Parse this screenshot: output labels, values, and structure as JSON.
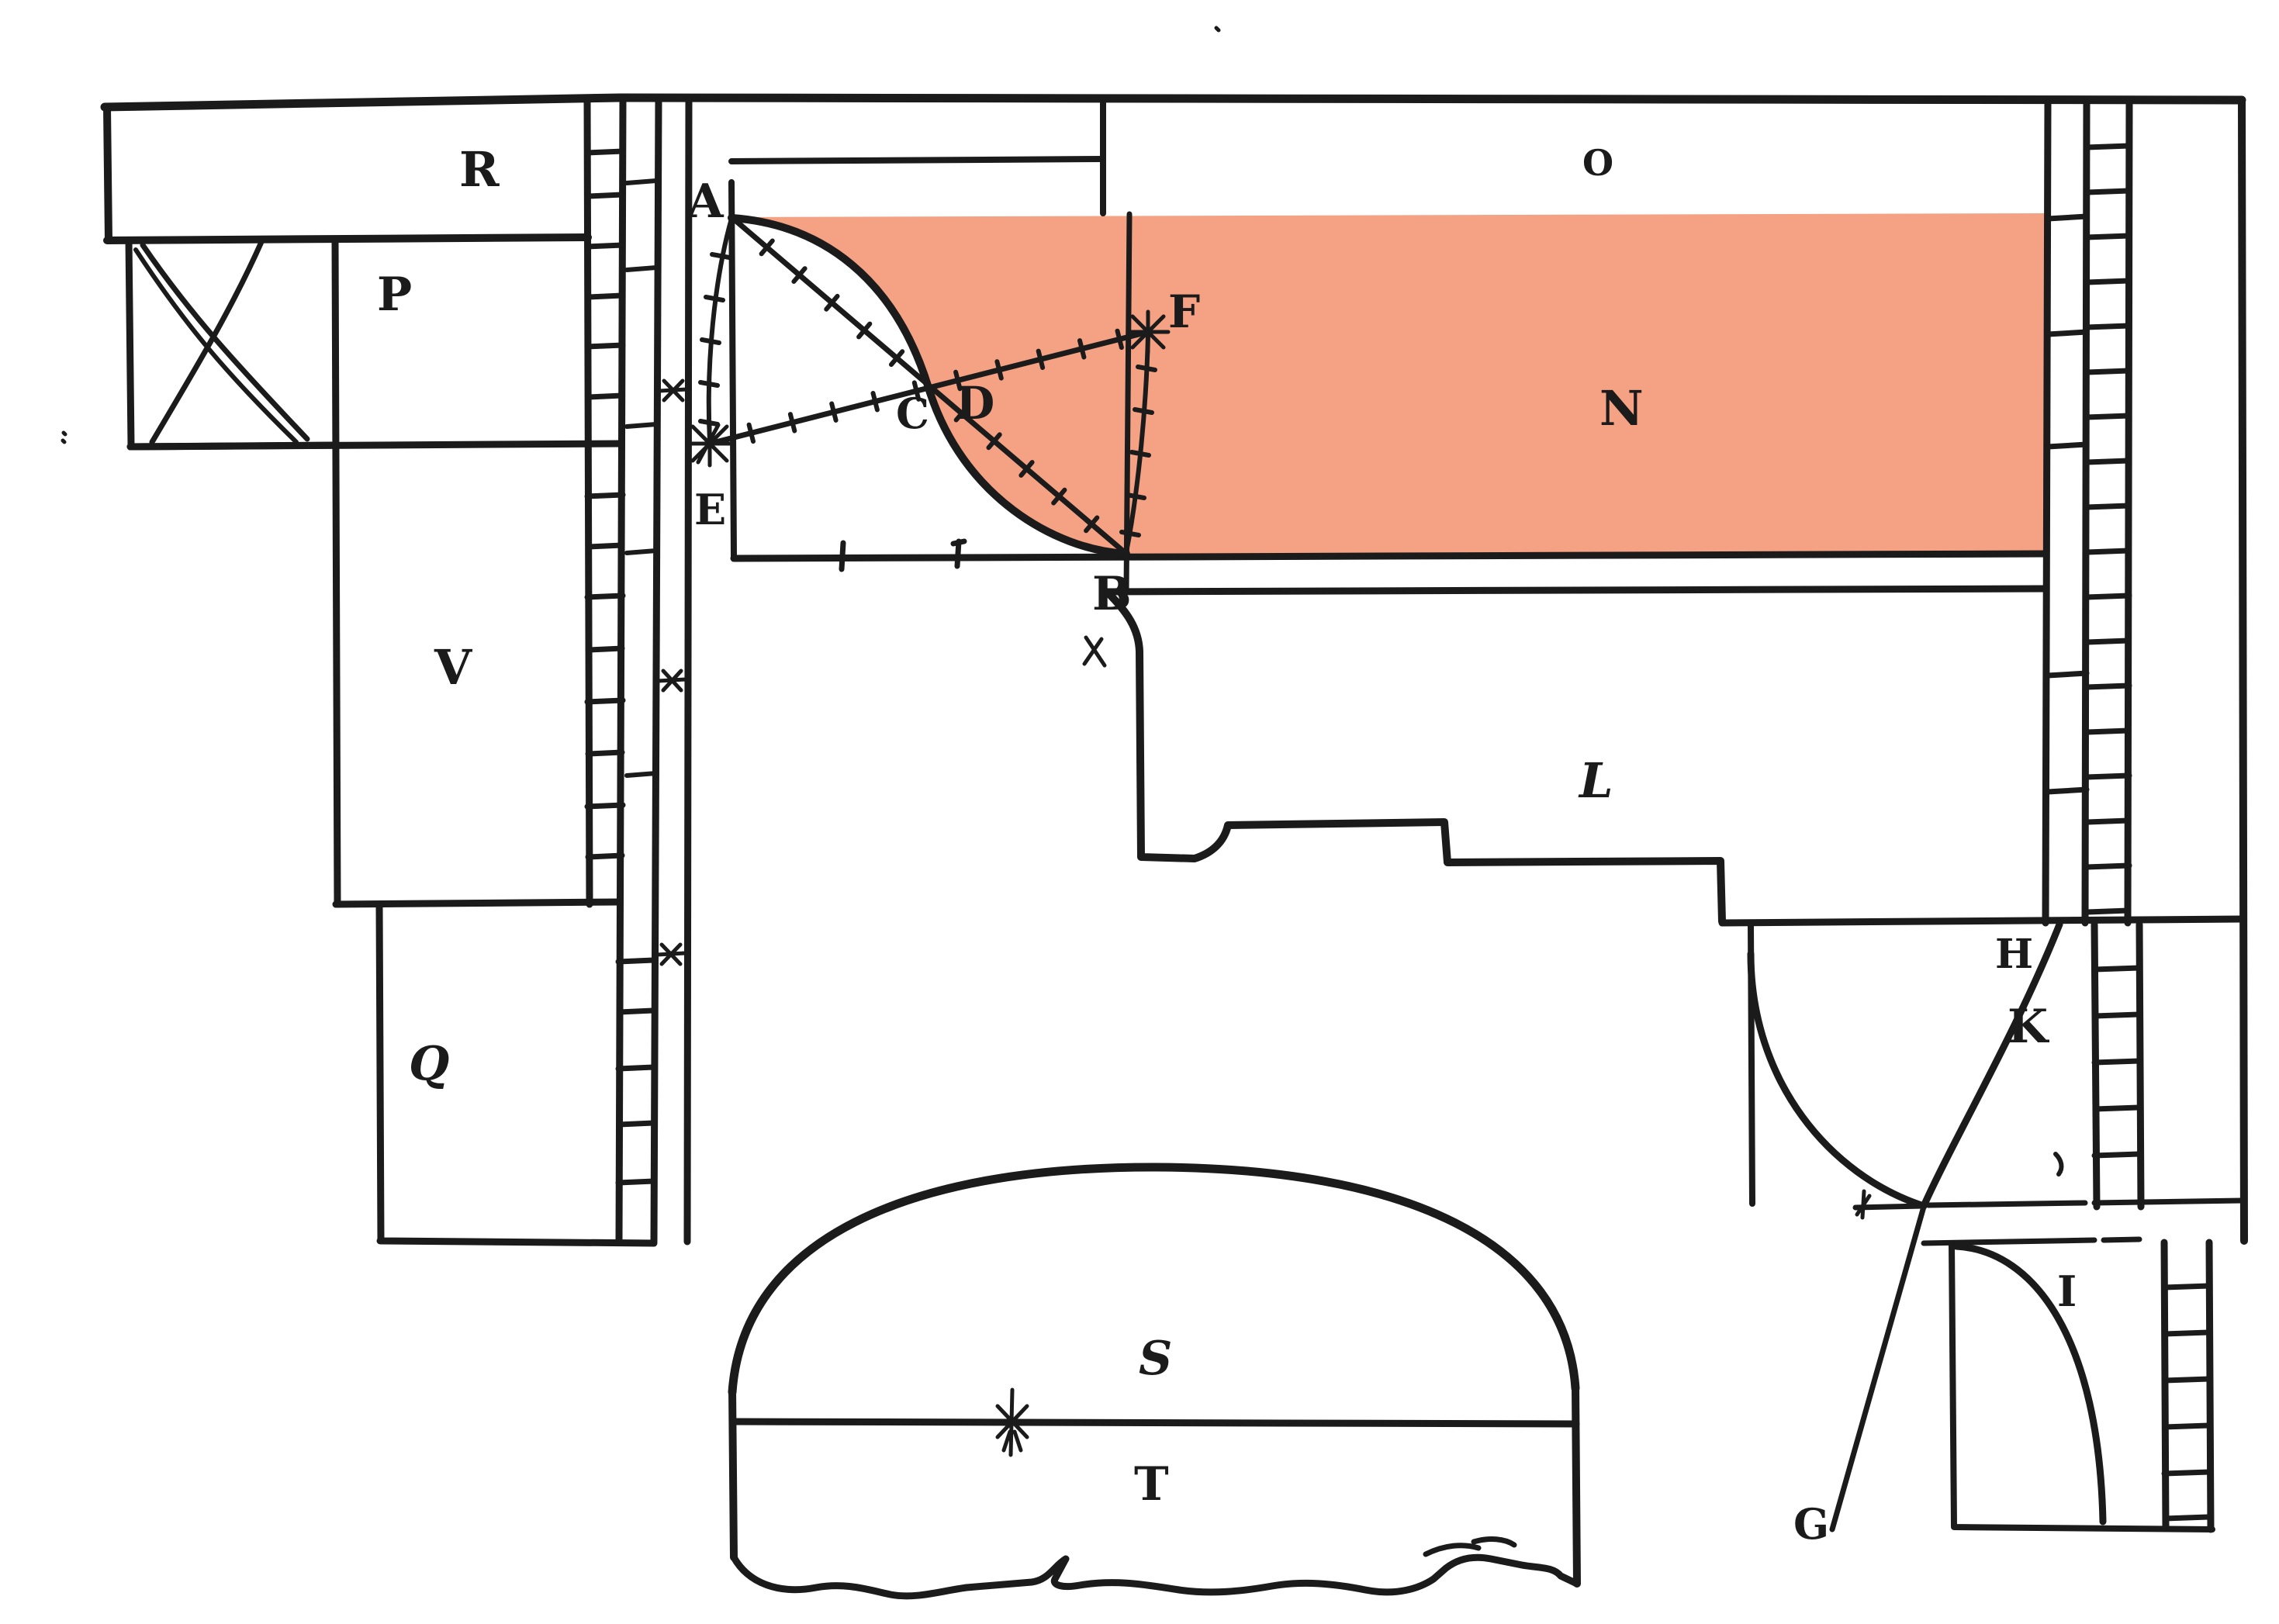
{
  "colors": {
    "ink": "#1b1b1b",
    "highlight": "#f5a183",
    "paper": "#ffffff"
  },
  "labels": {
    "A": "A",
    "B": "B",
    "C": "C",
    "D": "D",
    "E": "E",
    "F": "F",
    "G": "G",
    "H": "H",
    "I": "I",
    "K": "K",
    "L": "L",
    "N": "N",
    "O": "O",
    "P": "P",
    "Q": "Q",
    "R": "R",
    "S": "S",
    "T": "T",
    "V": "V"
  },
  "marks": {
    "star_e": "asterisk-star",
    "star_f": "asterisk-star",
    "arch_center": "asterisk-burst",
    "cross_ruler_1": "x-mark",
    "cross_ruler_2": "x-mark",
    "cross_ruler_3": "x-mark",
    "cross_under_b": "x-mark",
    "cross_k_line": "plus-tick"
  }
}
